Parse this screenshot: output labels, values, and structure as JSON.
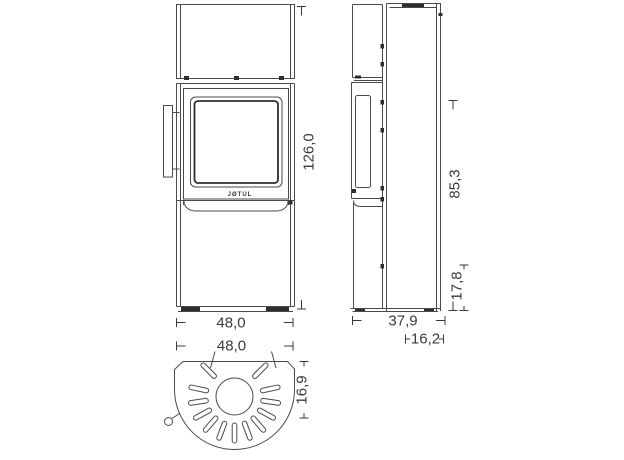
{
  "front_view": {
    "width_label": "48,0",
    "height_label": "126,0"
  },
  "side_view": {
    "depth_label": "37,9",
    "upper_depth_label": "16,2",
    "height_label": "85,3",
    "lower_height_label": "17,8"
  },
  "top_view": {
    "width_label": "48,0",
    "depth_label": "16,9"
  },
  "door": {
    "logo": "JØTUL"
  },
  "colors": {
    "line": "#4a4a4a",
    "text": "#3a3a3a",
    "background": "#ffffff"
  }
}
